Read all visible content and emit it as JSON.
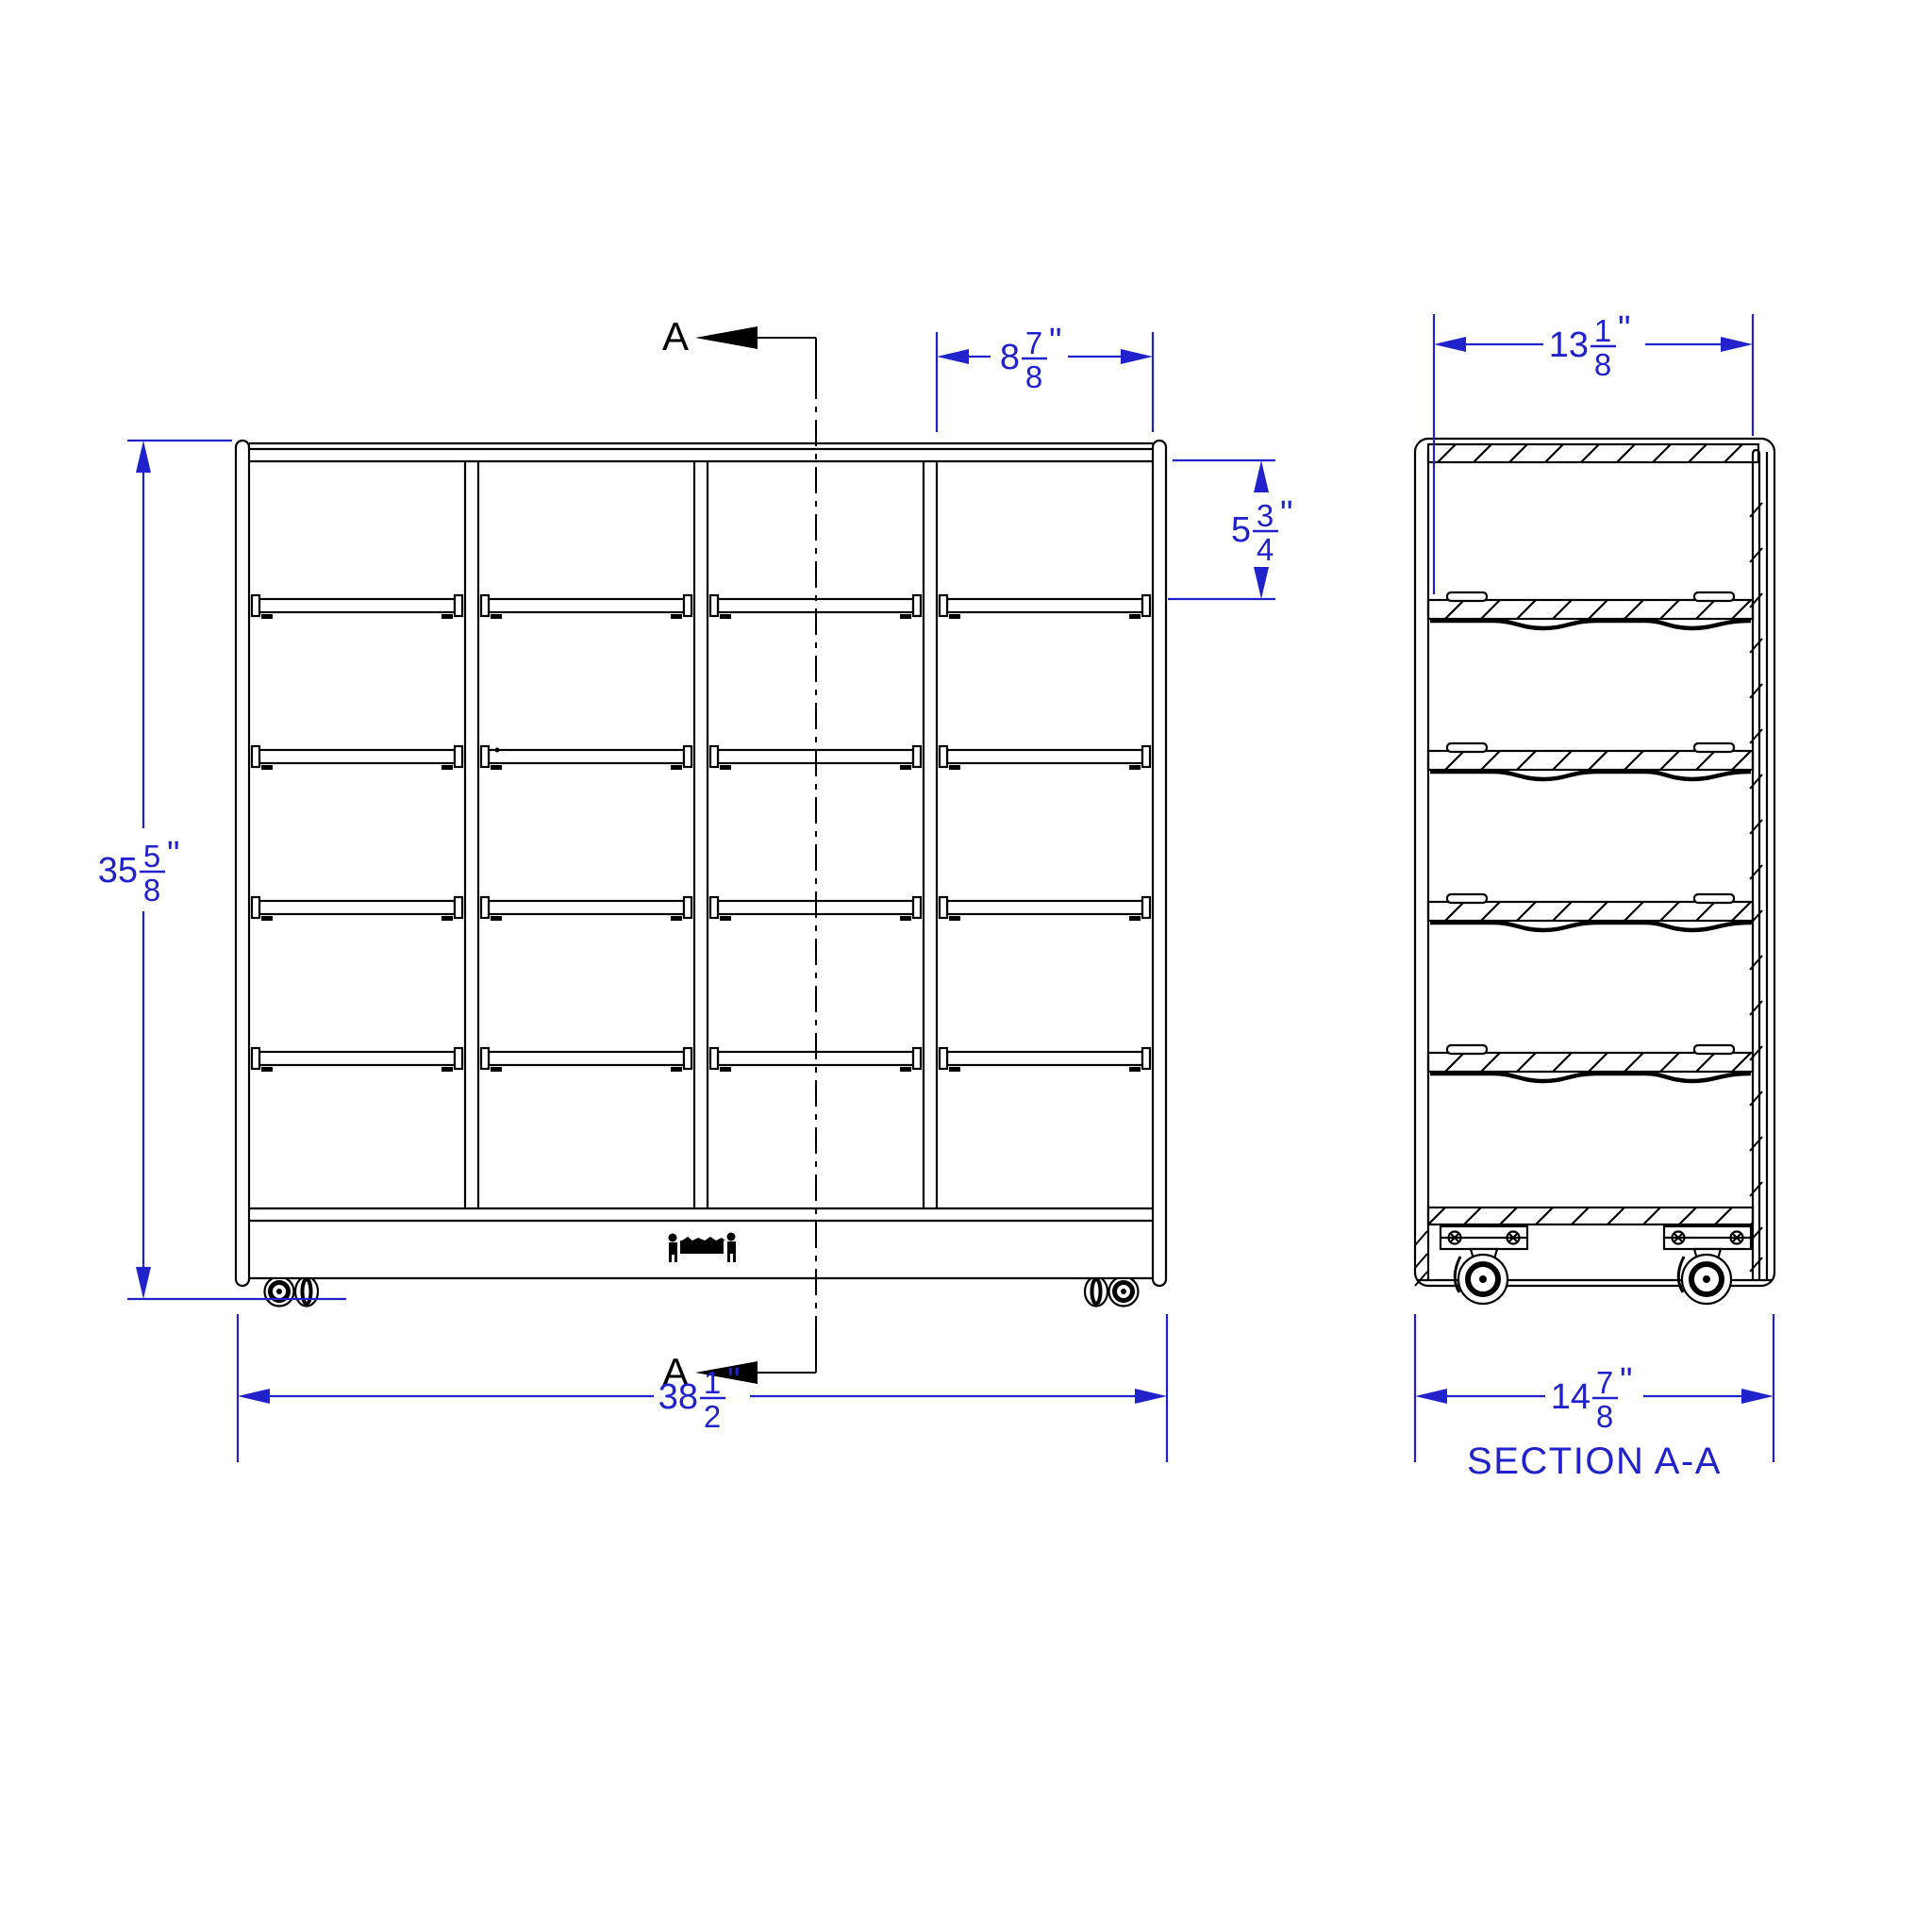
{
  "drawing": {
    "colors": {
      "dimension_blue": "#2222cc",
      "line_black": "#000000"
    },
    "section_marker": "A",
    "section_title": "SECTION A-A",
    "dimensions": {
      "cubby_width": {
        "whole": "8",
        "num": "7",
        "den": "8",
        "unit": "\""
      },
      "section_inner_width": {
        "whole": "13",
        "num": "1",
        "den": "8",
        "unit": "\""
      },
      "cubby_height": {
        "whole": "5",
        "num": "3",
        "den": "4",
        "unit": "\""
      },
      "front_height": {
        "whole": "35",
        "num": "5",
        "den": "8",
        "unit": "\""
      },
      "front_width": {
        "whole": "38",
        "num": "1",
        "den": "2",
        "unit": "\""
      },
      "section_depth": {
        "whole": "14",
        "num": "7",
        "den": "8",
        "unit": "\""
      }
    }
  }
}
